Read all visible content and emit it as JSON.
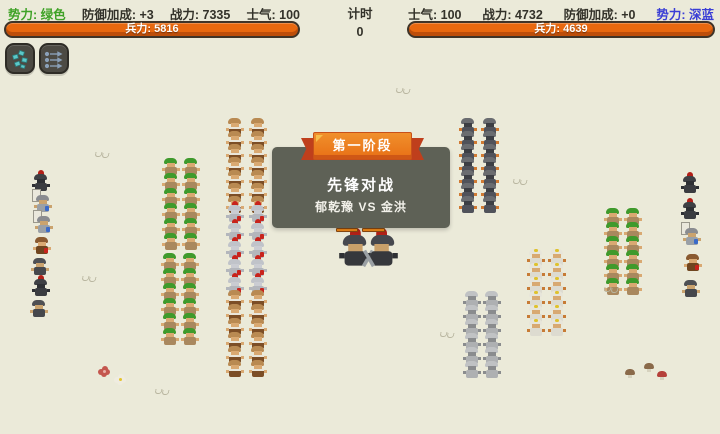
{
  "colors": {
    "background": "#ebead9",
    "green_faction": "#3fa227",
    "blue_faction": "#3a3ed6",
    "troop_bar": "#e8680f",
    "hp_bar": "#f28a18",
    "panel": "#5e6156",
    "banner_orange": "#e86f15"
  },
  "header": {
    "left": {
      "faction": "势力: 绿色",
      "defense": "防御加成: +3",
      "power": "战力: 7335",
      "morale": "士气: 100",
      "troops": "兵力: 5816"
    },
    "timer": {
      "label": "计时",
      "value": "0"
    },
    "right": {
      "morale": "士气: 100",
      "power": "战力: 4732",
      "defense": "防御加成: +0",
      "faction": "势力: 深蓝",
      "troops": "兵力: 4639"
    }
  },
  "toolbar": {
    "buttons": [
      {
        "icon": "formation-icon",
        "color": "#5cc8c8"
      },
      {
        "icon": "march-arrows-icon",
        "color": "#8aa0b8"
      }
    ]
  },
  "stage": {
    "banner": "第一阶段",
    "title": "先锋对战",
    "matchup": "郁乾豫 VS 金洪"
  },
  "battlefield": {
    "sprites": {
      "green": {
        "hat": "#3f9a2c",
        "head": "#d9a972",
        "body": "#a9885e",
        "arm": "#d9a972"
      },
      "brown": {
        "hat": "#b98a52",
        "head": "#d9a972",
        "body": "#7c4e26",
        "arm": "#d9a972",
        "band": "#eae6da"
      },
      "redsilver": {
        "hat": "#c0c3c9",
        "head": "#caccd2",
        "body": "#b3b6bc",
        "arm": "#b3b6bc",
        "plume": "#c8231c",
        "accent": "#c8231c"
      },
      "darkgray": {
        "hat": "#6a6c70",
        "head": "#3c3e44",
        "body": "#50525a",
        "arm": "#d07a33"
      },
      "silver": {
        "hat": "#c0c2c4",
        "head": "#8a8c8e",
        "body": "#aeb0b2",
        "arm": "#8a8c8e"
      },
      "whiteyellow": {
        "hat": "#e7e5da",
        "head": "#d8a972",
        "body": "#dddbd0",
        "arm": "#c77b35",
        "dot": "#dfc22c"
      },
      "elite-plume": {
        "hat": "#3e4044",
        "head": "#2e3034",
        "body": "#3a3c40",
        "arm": "#2e3034",
        "plume": "#b22018"
      },
      "elite-banner": {
        "hat": "#8a8c90",
        "head": "#caa36e",
        "body": "#9aa0a6",
        "arm": "#caa36e",
        "banner": "#eae8dc",
        "accent": "#3a6ac8"
      },
      "elite-brown": {
        "hat": "#8a5a30",
        "head": "#d9a972",
        "body": "#6f451f",
        "arm": "#d9a972",
        "accent": "#c8231c"
      },
      "elite-gray": {
        "hat": "#4e5054",
        "head": "#caa36e",
        "body": "#46484c",
        "arm": "#caa36e"
      },
      "champion": {
        "hat": "#46484e",
        "head": "#c9a06a",
        "body": "#36383c",
        "arm": "#2e3034",
        "plume": "#b22018",
        "sword": "#9aa0a4"
      }
    },
    "clusters": [
      {
        "name": "left-elite-column",
        "x": 30,
        "y": 174,
        "cols": 1,
        "dx": 0,
        "rows": 7,
        "dy": 21,
        "xoff": [
          3,
          5,
          6,
          4,
          2,
          3,
          1
        ],
        "types": [
          "elite-plume",
          "elite-banner",
          "elite-banner",
          "elite-brown",
          "elite-gray",
          "elite-plume",
          "elite-gray"
        ]
      },
      {
        "name": "green-archers-upper",
        "type": "green",
        "x": 163,
        "y": 158,
        "cols": 2,
        "dx": 20,
        "rows": 6,
        "dy": 15
      },
      {
        "name": "brown-infantry-upper",
        "type": "brown",
        "x": 227,
        "y": 118,
        "cols": 2,
        "dx": 23,
        "rows": 7,
        "dy": 13
      },
      {
        "name": "red-silver-guards",
        "type": "redsilver",
        "x": 227,
        "y": 205,
        "cols": 2,
        "dx": 23,
        "rows": 5,
        "dy": 18
      },
      {
        "name": "green-archers-lower",
        "type": "green",
        "x": 162,
        "y": 253,
        "cols": 2,
        "dx": 20,
        "rows": 6,
        "dy": 15
      },
      {
        "name": "brown-infantry-lower",
        "type": "brown",
        "x": 227,
        "y": 290,
        "cols": 2,
        "dx": 23,
        "rows": 6,
        "dy": 14
      },
      {
        "name": "darkgray-infantry-right",
        "type": "darkgray",
        "x": 460,
        "y": 118,
        "cols": 2,
        "dx": 22,
        "rows": 7,
        "dy": 13
      },
      {
        "name": "silver-infantry-right",
        "type": "silver",
        "x": 464,
        "y": 291,
        "cols": 2,
        "dx": 20,
        "rows": 6,
        "dy": 14
      },
      {
        "name": "white-yellow-infantry",
        "type": "whiteyellow",
        "x": 528,
        "y": 249,
        "cols": 2,
        "dx": 21,
        "rows": 6,
        "dy": 14
      },
      {
        "name": "green-archers-right",
        "type": "green",
        "x": 605,
        "y": 208,
        "cols": 2,
        "dx": 20,
        "rows": 6,
        "dy": 14
      },
      {
        "name": "right-elite-column",
        "x": 681,
        "y": 176,
        "cols": 1,
        "dx": 0,
        "rows": 5,
        "dy": 26,
        "xoff": [
          1,
          1,
          3,
          4,
          2
        ],
        "types": [
          "elite-plume",
          "elite-plume",
          "elite-banner",
          "elite-brown",
          "elite-gray"
        ]
      }
    ],
    "champions": [
      {
        "name": "vanguard-left",
        "type": "champion",
        "x": 341,
        "y": 235,
        "scale": 1.8,
        "mirror": false,
        "hp_x": 336,
        "hp_y": 228,
        "hp_w": 22
      },
      {
        "name": "vanguard-right",
        "type": "champion",
        "x": 396,
        "y": 235,
        "scale": 1.8,
        "mirror": true,
        "hp_x": 362,
        "hp_y": 228,
        "hp_w": 23
      }
    ],
    "decorations": {
      "grass": [
        [
          95,
          152
        ],
        [
          396,
          88
        ],
        [
          513,
          179
        ],
        [
          82,
          276
        ],
        [
          604,
          287
        ],
        [
          440,
          332
        ],
        [
          155,
          389
        ]
      ],
      "flowers": [
        {
          "x": 101,
          "y": 368,
          "petal": "#c4574e",
          "center": "#e8b0a8"
        },
        {
          "x": 117,
          "y": 376,
          "petal": "#efece0",
          "center": "#e3c32c"
        }
      ],
      "mushrooms": [
        {
          "x": 625,
          "y": 369,
          "cap": "#8a6a4a"
        },
        {
          "x": 644,
          "y": 363,
          "cap": "#8a6a4a"
        },
        {
          "x": 657,
          "y": 371,
          "cap": "#b5413a"
        }
      ]
    }
  }
}
